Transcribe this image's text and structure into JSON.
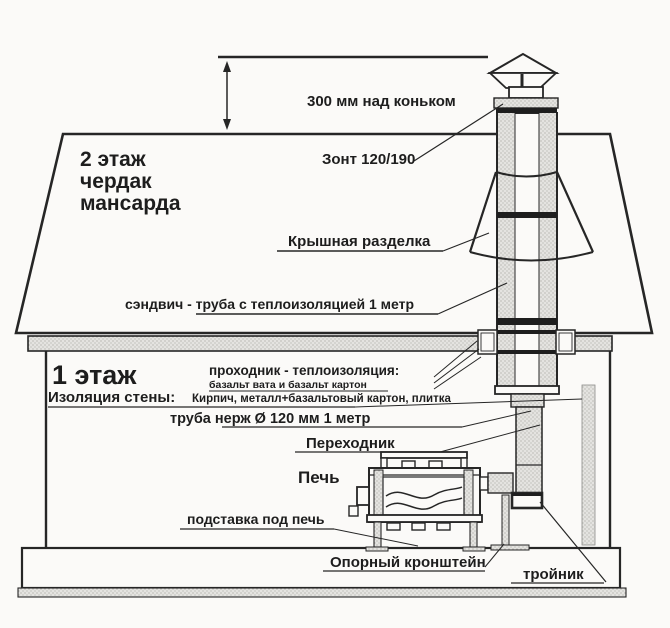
{
  "title": "Схема монтажа дымохода через крышу (сэндвич-дымоход для печи)",
  "colors": {
    "ink": "#262626",
    "paper": "#fbfaf8",
    "hatch_bg": "#e4e3e0",
    "hatch_dot": "#a9a8a4",
    "joint_band": "#1e1e1e"
  },
  "labels": {
    "above_ridge": "300 мм над коньком",
    "cap": "Зонт 120/190",
    "attic_line1": "2 этаж",
    "attic_line2": "чердак",
    "attic_line3": "мансарда",
    "roof_flashing": "Крышная разделка",
    "sandwich_pipe": "сэндвич - труба с теплоизоляцией 1 метр",
    "first_floor": "1 этаж",
    "pass_through_title": "проходник - теплоизоляция:",
    "pass_through_note": "базальт вата и базальт картон",
    "wall_insulation_title": "Изоляция стены:",
    "wall_insulation_note": "Кирпич, металл+базальтовый картон, плитка",
    "steel_pipe": "труба нерж Ø 120 мм 1 метр",
    "adapter": "Переходник",
    "stove": "Печь",
    "stove_stand": "подставка под печь",
    "support_bracket": "Опорный кронштейн",
    "tee": "тройник"
  }
}
